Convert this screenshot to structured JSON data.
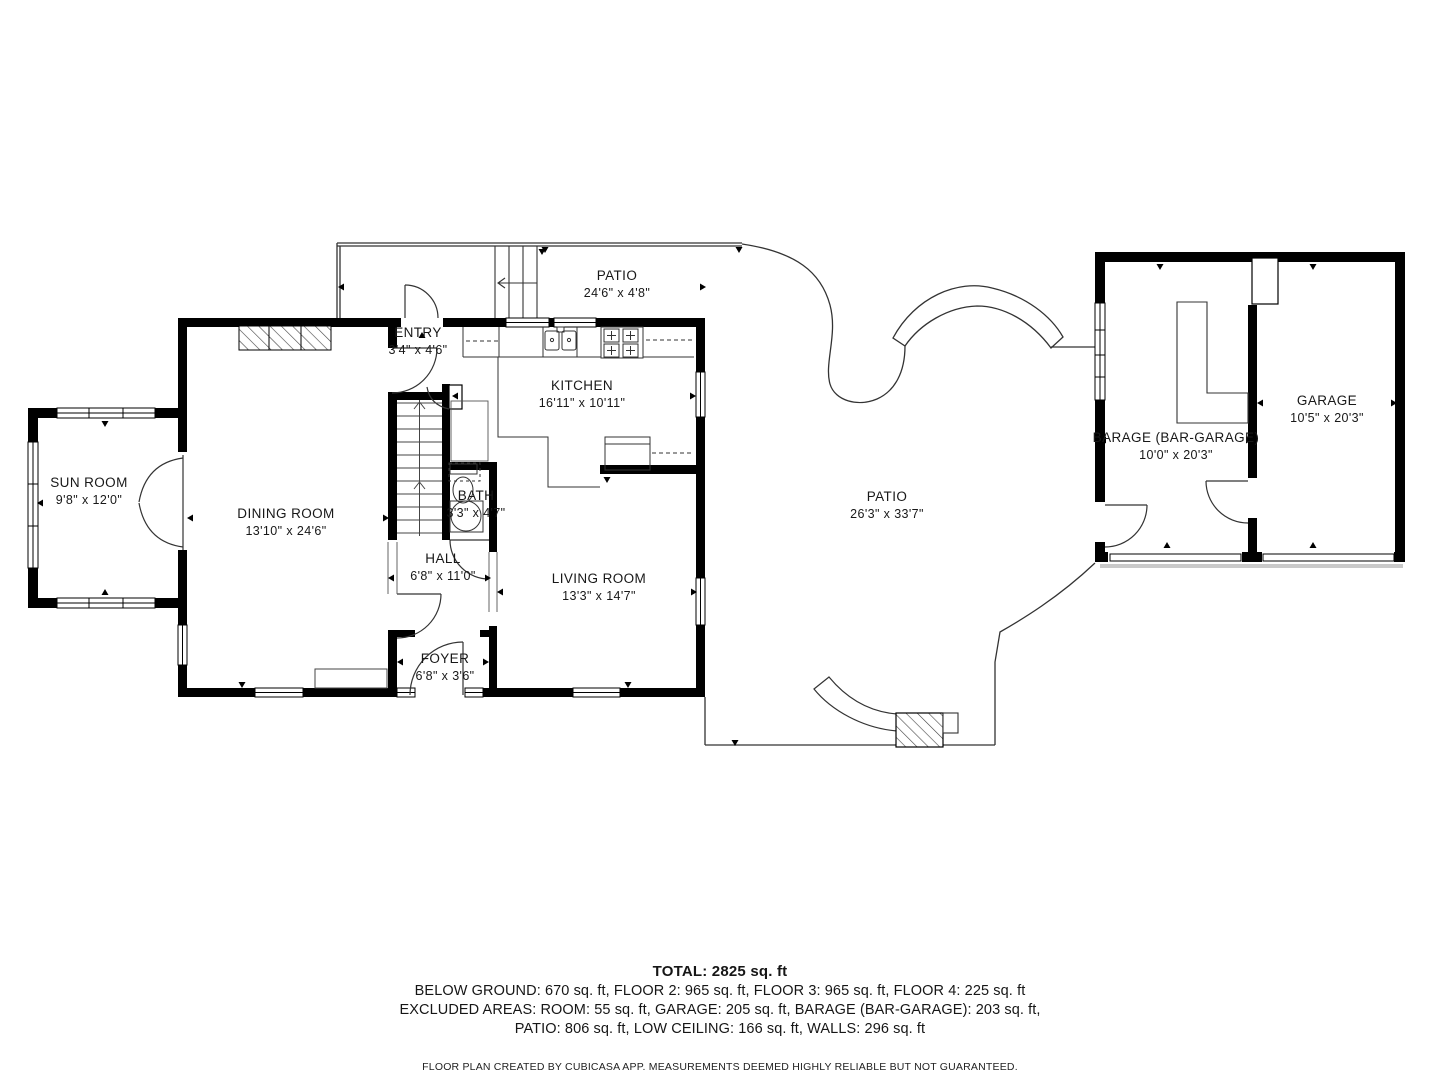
{
  "rooms": [
    {
      "id": "patio-top",
      "name": "PATIO",
      "dims": "24'6\" x 4'8\""
    },
    {
      "id": "sun-room",
      "name": "SUN ROOM",
      "dims": "9'8\" x 12'0\""
    },
    {
      "id": "dining-room",
      "name": "DINING ROOM",
      "dims": "13'10\" x 24'6\""
    },
    {
      "id": "entry",
      "name": "ENTRY",
      "dims": "3'4\" x 4'6\""
    },
    {
      "id": "kitchen",
      "name": "KITCHEN",
      "dims": "16'11\" x 10'11\""
    },
    {
      "id": "bath",
      "name": "BATH",
      "dims": "3'3\" x 4'7\""
    },
    {
      "id": "hall",
      "name": "HALL",
      "dims": "6'8\" x 11'0\""
    },
    {
      "id": "living-room",
      "name": "LIVING ROOM",
      "dims": "13'3\" x 14'7\""
    },
    {
      "id": "foyer",
      "name": "FOYER",
      "dims": "6'8\" x 3'6\""
    },
    {
      "id": "patio-main",
      "name": "PATIO",
      "dims": "26'3\" x 33'7\""
    },
    {
      "id": "barage",
      "name": "BARAGE (BAR-GARAGE)",
      "dims": "10'0\" x 20'3\""
    },
    {
      "id": "garage",
      "name": "GARAGE",
      "dims": "10'5\" x 20'3\""
    }
  ],
  "footer": {
    "total": "TOTAL: 2825 sq. ft",
    "line1": "BELOW GROUND: 670 sq. ft, FLOOR 2: 965 sq. ft, FLOOR 3: 965 sq. ft, FLOOR 4: 225 sq. ft",
    "line2": "EXCLUDED AREAS: ROOM: 55 sq. ft, GARAGE: 205 sq. ft, BARAGE (BAR-GARAGE): 203 sq. ft,",
    "line3": "PATIO: 806 sq. ft, LOW CEILING: 166 sq. ft, WALLS: 296 sq. ft",
    "disclaimer": "FLOOR PLAN CREATED BY CUBICASA APP. MEASUREMENTS DEEMED HIGHLY RELIABLE BUT NOT GUARANTEED."
  },
  "colors": {
    "wall": "#000000",
    "thin_line": "#333333",
    "text": "#161616",
    "driveway": "#c9c9c9",
    "background": "#ffffff"
  }
}
